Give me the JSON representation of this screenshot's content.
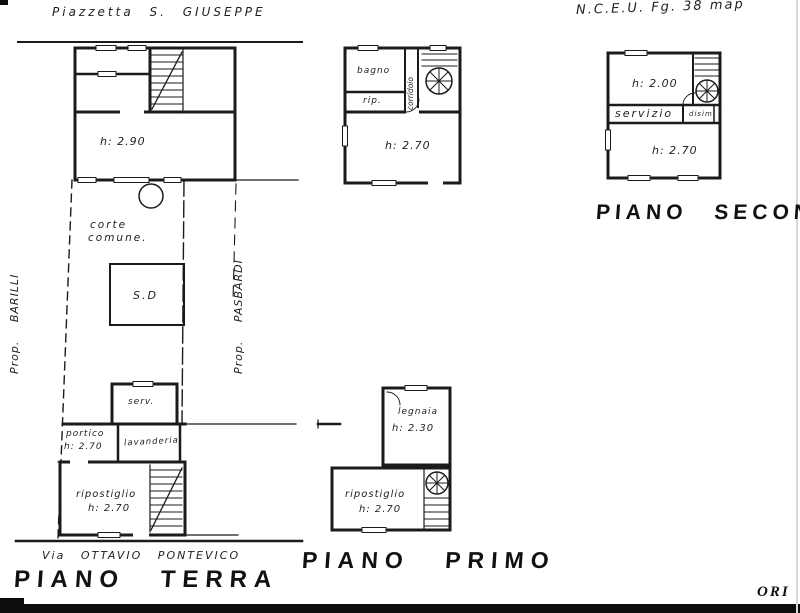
{
  "drawing": {
    "header": {
      "street_top": "Piazzetta  S.  GIUSEPPE",
      "cadastre_ref": "N.C.E.U.   Fg. 38 map"
    },
    "ground_floor": {
      "title": "PIANO TERRA",
      "street_bottom": "Via  OTTAVIO  PONTEVICO",
      "neighbor_left": "Prop.   BARILLI",
      "neighbor_right": "Prop.   PASBARDI",
      "rooms": {
        "main_height": "h: 2.90",
        "courtyard_line1": "corte",
        "courtyard_line2": "comune.",
        "shed": "S.D",
        "service": "serv.",
        "portico": "portico",
        "portico_height": "h: 2.70",
        "laundry": "lavanderia",
        "storage": "ripostiglio",
        "storage_height": "h: 2.70"
      }
    },
    "first_floor": {
      "title": "PIANO PRIMO",
      "rooms": {
        "bathroom": "bagno",
        "closet": "rip.",
        "corridor": "corridoio",
        "main_height": "h: 2.70",
        "woodshed": "legnaia",
        "woodshed_height": "h: 2.30",
        "storage": "ripostiglio",
        "storage_height": "h: 2.70"
      }
    },
    "second_floor": {
      "title": "PIANO SECONDO",
      "rooms": {
        "attic_height": "h: 2.00",
        "service": "servizio",
        "hall": "disim.",
        "main_height": "h: 2.70"
      }
    },
    "stamp_fragment": "ORI"
  },
  "colors": {
    "ink": "#1b1b1b",
    "scan_black": "#0d0d0d",
    "paper": "#ffffff"
  }
}
